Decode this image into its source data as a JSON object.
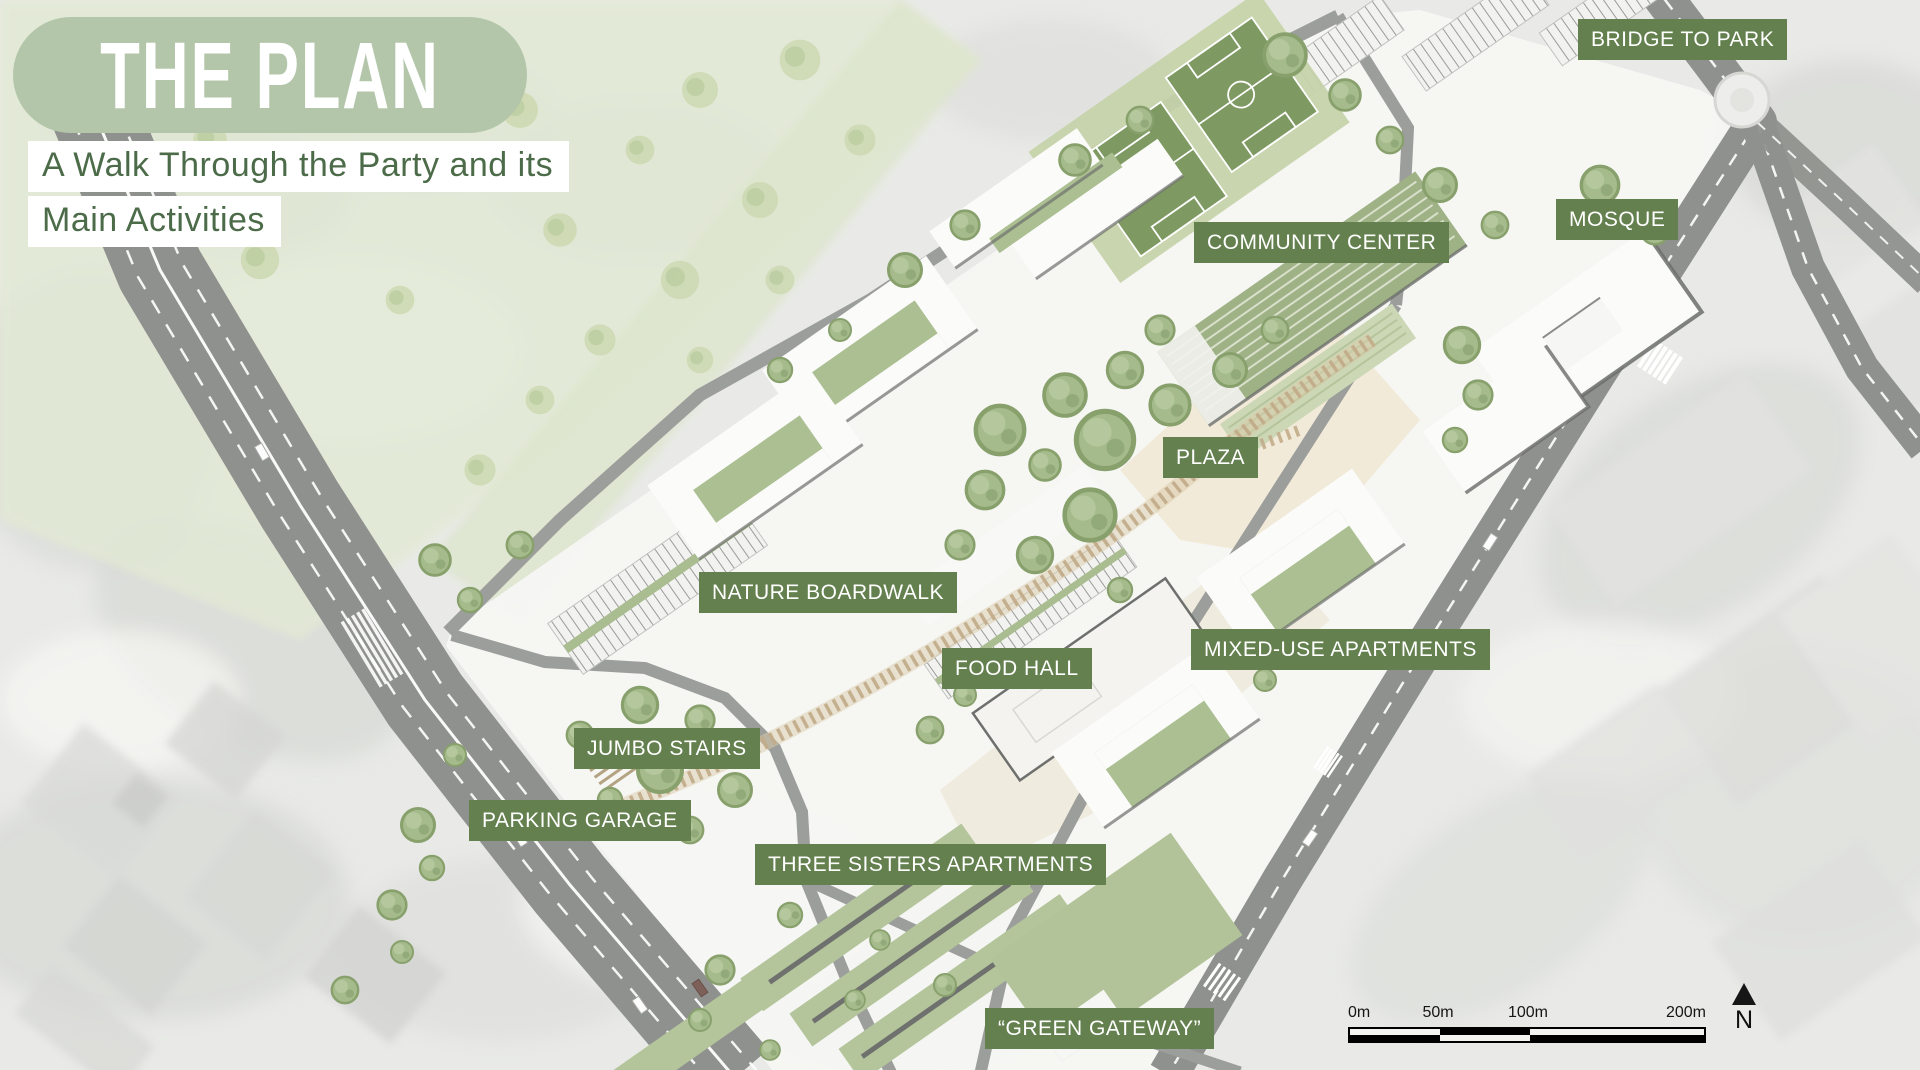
{
  "slide": {
    "title": "THE PLAN",
    "subtitle_line1": "A Walk Through the Party and its",
    "subtitle_line2": "Main Activities"
  },
  "map_labels": [
    {
      "id": "bridge-to-park",
      "text": "BRIDGE TO PARK",
      "x": 1578,
      "y": 19
    },
    {
      "id": "mosque",
      "text": "MOSQUE",
      "x": 1556,
      "y": 199
    },
    {
      "id": "community-center",
      "text": "COMMUNITY CENTER",
      "x": 1194,
      "y": 222
    },
    {
      "id": "plaza",
      "text": "PLAZA",
      "x": 1163,
      "y": 437
    },
    {
      "id": "nature-boardwalk",
      "text": "NATURE BOARDWALK",
      "x": 699,
      "y": 572
    },
    {
      "id": "food-hall",
      "text": "FOOD HALL",
      "x": 942,
      "y": 648
    },
    {
      "id": "mixed-use-apartments",
      "text": "MIXED-USE APARTMENTS",
      "x": 1191,
      "y": 629
    },
    {
      "id": "jumbo-stairs",
      "text": "JUMBO STAIRS",
      "x": 574,
      "y": 728
    },
    {
      "id": "parking-garage",
      "text": "PARKING GARAGE",
      "x": 469,
      "y": 800
    },
    {
      "id": "three-sisters-apartments",
      "text": "THREE SISTERS APARTMENTS",
      "x": 755,
      "y": 844
    },
    {
      "id": "green-gateway",
      "text": "“GREEN GATEWAY”",
      "x": 985,
      "y": 1008
    }
  ],
  "scale_bar": {
    "ticks": [
      "0m",
      "50m",
      "100m",
      "200m"
    ]
  },
  "north_arrow": {
    "label": "N"
  },
  "colors": {
    "label_bg": "#64804e",
    "title_pill": "#b4c6aa",
    "subtitle_text": "#4c6b49"
  }
}
